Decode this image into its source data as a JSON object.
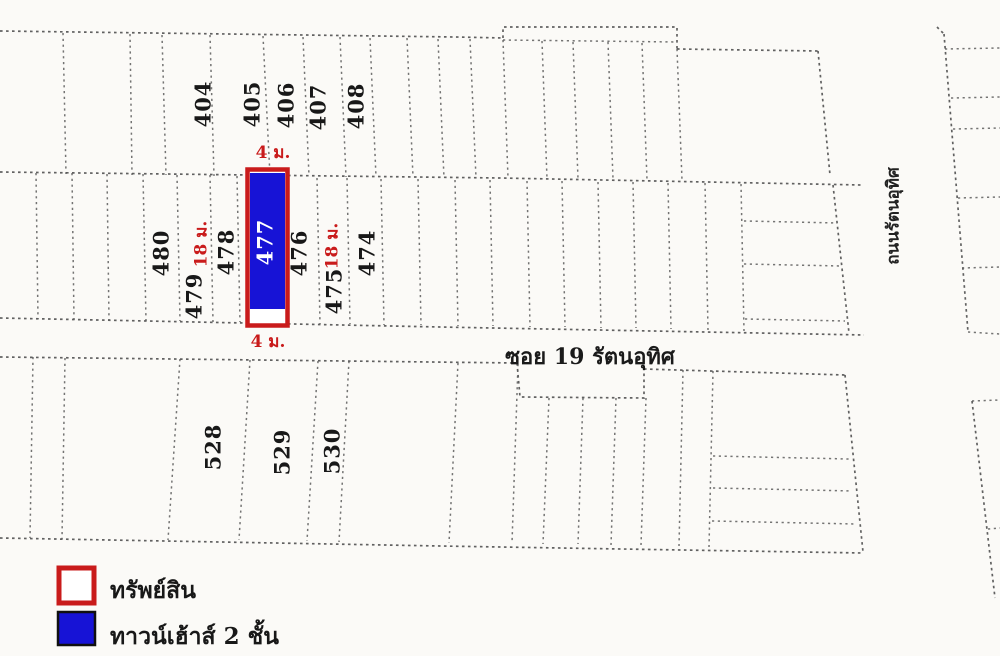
{
  "map": {
    "plots": {
      "top_row": [
        {
          "label": "404"
        },
        {
          "label": "405"
        },
        {
          "label": "406"
        },
        {
          "label": "407"
        },
        {
          "label": "408"
        }
      ],
      "middle_row": [
        {
          "label": "480"
        },
        {
          "label": "479"
        },
        {
          "label": "478"
        },
        {
          "label": "477",
          "highlighted": true
        },
        {
          "label": "476"
        },
        {
          "label": "475"
        },
        {
          "label": "474"
        }
      ],
      "bottom_row": [
        {
          "label": "528"
        },
        {
          "label": "529"
        },
        {
          "label": "530"
        }
      ]
    },
    "dimension_labels": {
      "top_width": "4 ม.",
      "bottom_width": "4 ม.",
      "left_depth": "18 ม.",
      "right_depth": "18 ม."
    },
    "street_labels": {
      "soi": "ซอย 19 รัตนอุทิศ",
      "road": "ถนนรัตนอุทิศ"
    }
  },
  "legend": {
    "items": [
      {
        "swatch": "red-outline",
        "label": "ทรัพย์สิน"
      },
      {
        "swatch": "blue-fill",
        "label": "ทาวน์เฮ้าส์ 2 ชั้น"
      }
    ]
  },
  "colors": {
    "highlight_blue": "#1713d6",
    "outline_red": "#c91b1b",
    "dim_red": "#c91b1b",
    "boundary_gray": "#545454",
    "paper": "#fbfaf7"
  }
}
